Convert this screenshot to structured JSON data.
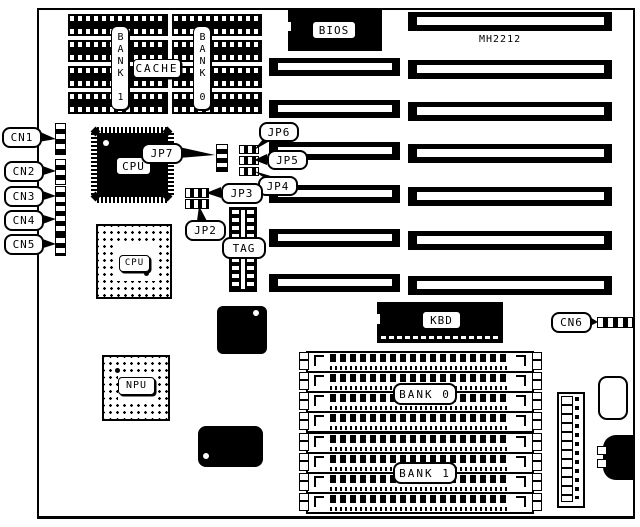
{
  "model_number": "MH2212",
  "chips": {
    "bios_label": "BIOS",
    "cache_label": "CACHE",
    "cache_bank1_label": "BANK 1",
    "cache_bank0_label": "BANK 0",
    "cpu_qfp_label": "CPU",
    "cpu_socket_label": "CPU",
    "npu_label": "NPU",
    "tag_label": "TAG",
    "kbd_label": "KBD"
  },
  "memory": {
    "simm_bank0_label": "BANK 0",
    "simm_bank1_label": "BANK 1",
    "simm_slot_count": 8
  },
  "expansion": {
    "long_slot_count": 7,
    "short_slot_count": 6
  },
  "cache": {
    "dip_rows_per_bank": 4
  },
  "connectors": [
    {
      "label": "CN1"
    },
    {
      "label": "CN2"
    },
    {
      "label": "CN3"
    },
    {
      "label": "CN4"
    },
    {
      "label": "CN5"
    },
    {
      "label": "CN6"
    }
  ],
  "jumpers": [
    {
      "label": "JP2"
    },
    {
      "label": "JP3"
    },
    {
      "label": "JP4"
    },
    {
      "label": "JP5"
    },
    {
      "label": "JP6"
    },
    {
      "label": "JP7"
    }
  ],
  "colors": {
    "ink": "#000000",
    "paper": "#ffffff"
  }
}
